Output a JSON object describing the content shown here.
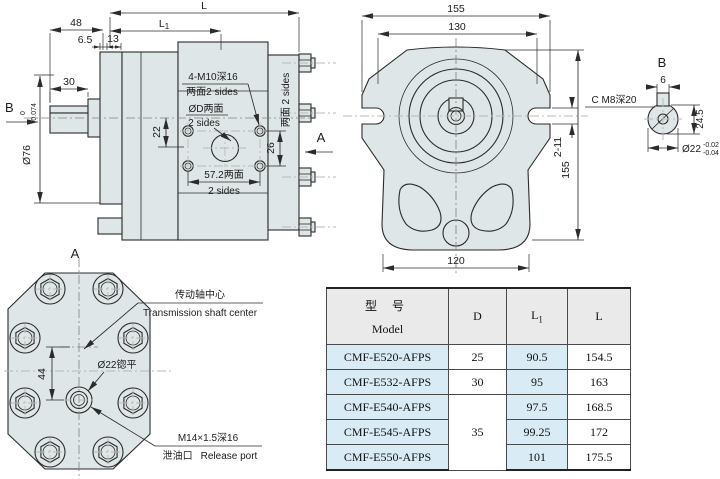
{
  "colors": {
    "body_fill": "#dfe6e7",
    "line": "#2b2b2b",
    "centerline_gray": "#b8b8b8",
    "table_blue": "#d9ecf6",
    "table_header_gray": "#eaeaea",
    "table_border": "#4a4a4a"
  },
  "side_view": {
    "view_label_b": "B",
    "view_label_a": "A",
    "dim_l": "L",
    "dim_l1_main": "L",
    "dim_l1_sub": "1",
    "dim_48": "48",
    "dim_6_5": "6.5",
    "dim_13": "13",
    "dim_30": "30",
    "dim_shaft_dia": "Ø76",
    "dim_shaft_tol_top": "0",
    "dim_shaft_tol_bot": "-0.074",
    "dim_22": "22",
    "dim_26": "26",
    "dim_57_line1": "57.2两面",
    "dim_57_line2": "2 sides",
    "note_m10_line1": "4-M10深16",
    "note_m10_line2": "两面2 sides",
    "note_port_line1": "ØD两面",
    "note_port_line2": "2 sides",
    "note_sides_vertical": "两面 2 sides"
  },
  "front_view": {
    "dim_155_top": "155",
    "dim_130": "130",
    "dim_120": "120",
    "dim_155_right": "155",
    "dim_slots": "2-11"
  },
  "detail_b": {
    "view_label": "B",
    "note_tap": "C M8深20",
    "dim_6": "6",
    "dim_24_5": "24.5",
    "dim_dia": "Ø22",
    "dim_tol_top": "-0.02",
    "dim_tol_bot": "-0.04"
  },
  "view_a": {
    "view_label": "A",
    "dim_44": "44",
    "note_spotface": "Ø22锪平",
    "note_shaft_cn": "传动轴中心",
    "note_shaft_en": "Transmission shaft center",
    "note_port_thread": "M14×1.5深16",
    "note_port_cn": "泄油口",
    "note_port_en": "Release port"
  },
  "table": {
    "header_model_cn": "型  号",
    "header_model_en": "Model",
    "header_d": "D",
    "header_l1_main": "L",
    "header_l1_sub": "1",
    "header_l": "L",
    "rows": [
      {
        "model": "CMF-E520-AFPS",
        "d": "25",
        "l1": "90.5",
        "l": "154.5"
      },
      {
        "model": "CMF-E532-AFPS",
        "d": "30",
        "l1": "95",
        "l": "163"
      },
      {
        "model": "CMF-E540-AFPS",
        "d": "35",
        "l1": "97.5",
        "l": "168.5"
      },
      {
        "model": "CMF-E545-AFPS",
        "l1": "99.25",
        "l": "172"
      },
      {
        "model": "CMF-E550-AFPS",
        "l1": "101",
        "l": "175.5"
      }
    ]
  }
}
